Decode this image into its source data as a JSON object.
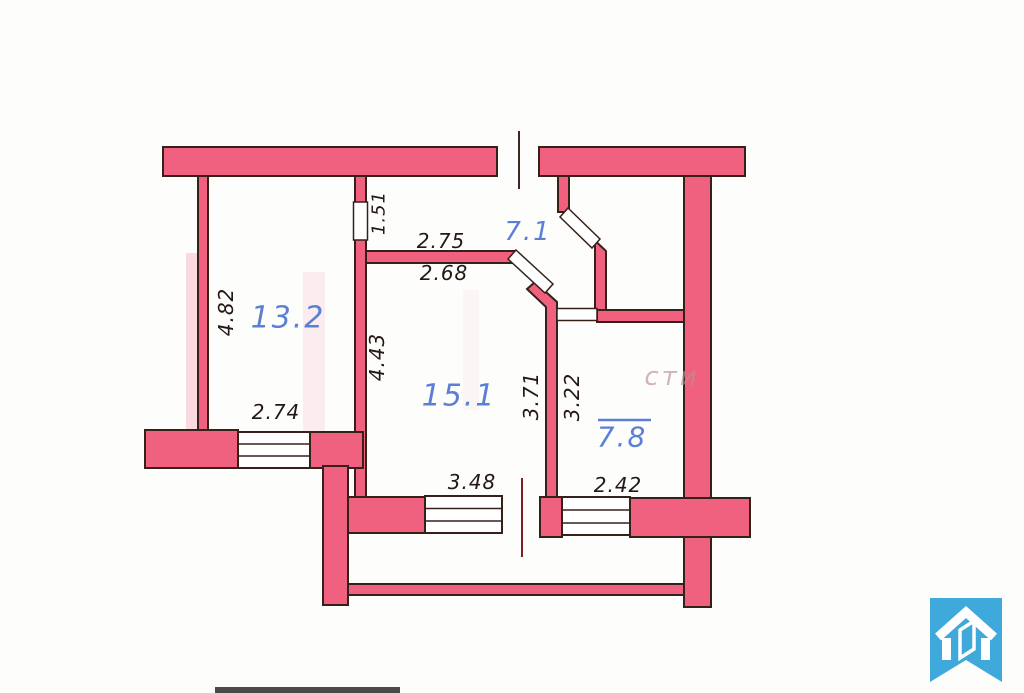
{
  "floorplan": {
    "rooms": [
      {
        "name": "room-13-2",
        "area_label": "13.2"
      },
      {
        "name": "room-7-1",
        "area_label": "7.1"
      },
      {
        "name": "room-15-1",
        "area_label": "15.1"
      },
      {
        "name": "room-7-8",
        "area_label": "7.8"
      }
    ],
    "dimensions": {
      "d_4_82": "4.82",
      "d_2_74": "2.74",
      "d_1_51": "1.51",
      "d_2_75": "2.75",
      "d_2_68": "2.68",
      "d_4_43": "4.43",
      "d_3_71": "3.71",
      "d_3_22": "3.22",
      "d_3_48": "3.48",
      "d_2_42": "2.42"
    },
    "watermark_fragment": "сти",
    "colors": {
      "wall_fill": "#f0617f",
      "wall_outline": "#35201a",
      "room_label_blue": "#5c7fd6",
      "dimension_text": "#241813",
      "door_centerline_red": "#7d1f24",
      "logo_blue": "#3fa9dc"
    }
  }
}
